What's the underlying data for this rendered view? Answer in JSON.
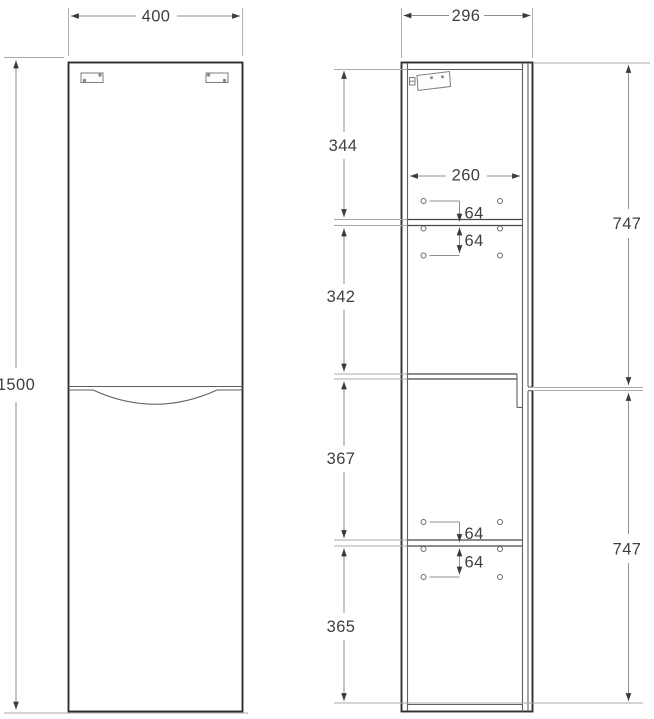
{
  "meta": {
    "description": "Technical dimension drawing of a tall two-door cabinet: front view and side view",
    "background": "#ffffff"
  },
  "colors": {
    "outline": "#2f2f2f",
    "inner_line": "#5f5f5f",
    "dimension_line": "#8f8f8f",
    "text": "#3f3f3f"
  },
  "front_view": {
    "width_dim": {
      "label": "400"
    },
    "height_dim": {
      "label": "1500"
    }
  },
  "side_view": {
    "depth_dim": {
      "label": "296"
    },
    "shelf_width_dim": {
      "label": "260"
    },
    "sections": {
      "top": {
        "label": "344"
      },
      "upper_middle": {
        "label": "342"
      },
      "lower_middle": {
        "label": "367"
      },
      "bottom": {
        "label": "365"
      }
    },
    "doors": {
      "upper": {
        "label": "747"
      },
      "lower": {
        "label": "747"
      }
    },
    "pin_offsets": {
      "upper_shelf_above": {
        "label": "64"
      },
      "upper_shelf_below": {
        "label": "64"
      },
      "lower_shelf_above": {
        "label": "64"
      },
      "lower_shelf_below": {
        "label": "64"
      }
    }
  }
}
